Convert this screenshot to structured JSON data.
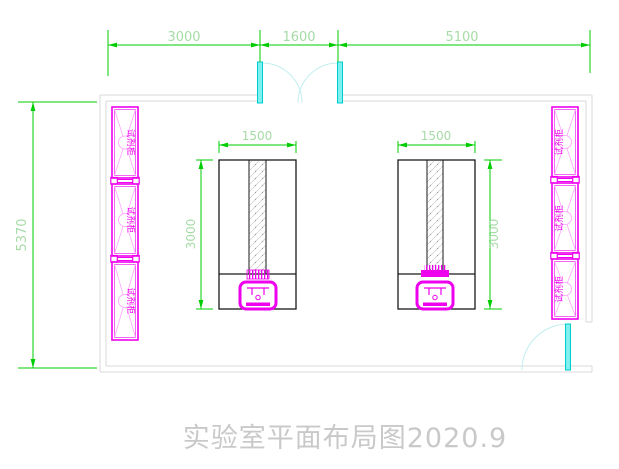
{
  "title": {
    "text": "实验室平面布局图2020.9"
  },
  "dimensions": {
    "top_left": "3000",
    "top_middle": "1600",
    "top_right": "5100",
    "left_height": "5370",
    "bench_left_width": "1500",
    "bench_left_depth": "3000",
    "bench_right_width": "1500",
    "bench_right_depth": "3000"
  },
  "cabinets": {
    "left": [
      {
        "label": "试剂柜"
      },
      {
        "label": "试剂柜"
      },
      {
        "label": "试剂柜"
      }
    ],
    "right": [
      {
        "label": "试剂柜"
      },
      {
        "label": "试剂柜"
      },
      {
        "label": "试剂柜"
      }
    ]
  },
  "colors": {
    "dimension_line": "#00cc00",
    "dimension_text": "#a6dba6",
    "wall_line": "#d9d9d9",
    "cabinet_magenta": "#ee00ee",
    "door_leaf_cyan": "#7ff0f0",
    "door_arc_cyan": "#c2eef0",
    "bench_outline": "#1a1a1a",
    "title_gray": "#c9c9c9"
  }
}
